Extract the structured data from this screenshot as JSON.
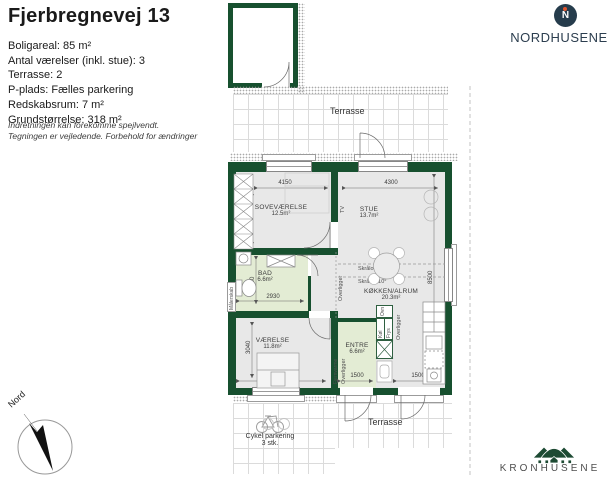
{
  "header": {
    "title": "Fjerbregnevej 13",
    "details": [
      "Boligareal: 85 m²",
      "Antal værelser (inkl. stue): 3",
      "Terrasse: 2",
      "P-plads: Fælles parkering",
      "Redskabsrum: 7 m²",
      "Grundstørrelse: 318 m²"
    ],
    "disclaimer": [
      "Indretningen kan forekomme spejlvendt.",
      "Tegningen er vejledende. Forbehold for ændringer"
    ]
  },
  "logos": {
    "nordhusene_initial": "N",
    "nordhusene_text": "NORDHUSENE",
    "kronhusene_text": "KRONHUSENE"
  },
  "plan": {
    "nord": "Nord",
    "terrasse_top": "Terrasse",
    "terrasse_bottom": "Terrasse",
    "cykel_line1": "Cykel parkering",
    "cykel_line2": "3 stk.",
    "rooms": [
      {
        "name": "SOVEVÆRELSE",
        "area": "12.5m²"
      },
      {
        "name": "STUE",
        "area": "13.7m²"
      },
      {
        "name": "BAD",
        "area": "6.6m²"
      },
      {
        "name": "VÆRELSE",
        "area": "11.8m²"
      },
      {
        "name": "ENTRE",
        "area": "6.6m²"
      },
      {
        "name": "KØKKEN/ALRUM",
        "area": "20.3m²"
      }
    ],
    "dims": {
      "sove_w": "4150",
      "sove_h": "3000",
      "stue_w": "4300",
      "right_h": "8500",
      "bad_h": "2260",
      "bad_w": "2930",
      "vaerelse_h": "3040",
      "vaerelse_w": "3550",
      "entre_door_w": "1500",
      "kitchen_door_w": "1500"
    },
    "ann": {
      "tv": "TV",
      "skraaloft": "Skråloft 10°",
      "overligger": "Overligger",
      "fjernvarme": "Fjernvarme",
      "maalerskab": "Målerskab",
      "ovn": "Ovn",
      "koel": "Køl",
      "frys": "Frys"
    }
  }
}
